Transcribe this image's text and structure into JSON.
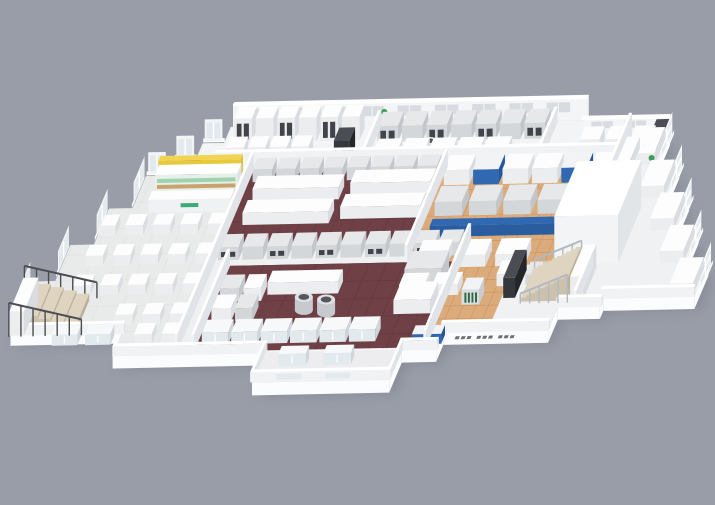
{
  "meta": {
    "description": "Isometric 3D cutaway architectural rendering of a facility floor plan with dining hall, kiosk shop, commercial kitchens on maroon floors, a wood-floored production area with machinery, lab wing, staircases and perimeter bay windows"
  },
  "scene": {
    "canvas": {
      "w": 715,
      "h": 505,
      "bg": "#989da8"
    },
    "proj": {
      "ox": 233,
      "oy": 127,
      "ux": 0.98,
      "uy": -0.02,
      "vx": -0.42,
      "vy": 1
    },
    "palette": {
      "slabSide": "#fbfcfe",
      "floorBase": "#f3f4f6",
      "dining": "#e9ebeb",
      "diningGrid": "#e0e3e3",
      "maroon": "#6f4147",
      "maroonGrid": "#643940",
      "wood": "#dcab7c",
      "woodGrid": "#cc9763",
      "corridor": "#eef0f1",
      "wing": "#eff1f3",
      "porch": "#ededef",
      "wallFace": "#f4f5f7",
      "wallWindow": "#d8dce1",
      "glass": "#e3eaee",
      "blue": "#3069b1",
      "yellow": "#f0d452",
      "greenLogo": "#3cab77",
      "shelfGreen": "#9fd3ae",
      "shelfWood": "#c9a36d",
      "steps": "#ded4c0",
      "railDark": "#4b4d52",
      "railLight": "#b3b9c0",
      "plant": "#3f9d5a",
      "shadow": "#787d88"
    },
    "outline": [
      [
        0,
        0
      ],
      [
        362,
        0
      ],
      [
        362,
        15
      ],
      [
        452,
        15
      ],
      [
        452,
        48
      ],
      [
        476,
        48
      ],
      [
        476,
        81
      ],
      [
        500,
        81
      ],
      [
        500,
        114
      ],
      [
        524,
        114
      ],
      [
        524,
        147
      ],
      [
        548,
        147
      ],
      [
        548,
        180
      ],
      [
        455,
        180
      ],
      [
        455,
        188
      ],
      [
        412,
        188
      ],
      [
        412,
        211
      ],
      [
        305,
        211
      ],
      [
        305,
        228
      ],
      [
        270,
        228
      ],
      [
        270,
        258
      ],
      [
        130,
        258
      ],
      [
        130,
        228
      ],
      [
        -25,
        228
      ],
      [
        -25,
        203
      ],
      [
        -140,
        203
      ],
      [
        -140,
        152
      ],
      [
        -116,
        152
      ],
      [
        -116,
        116
      ],
      [
        -92,
        116
      ],
      [
        -92,
        80
      ],
      [
        -68,
        80
      ],
      [
        -68,
        48
      ],
      [
        -46,
        48
      ],
      [
        -46,
        32
      ],
      [
        -24,
        32
      ],
      [
        -24,
        16
      ],
      [
        -2,
        16
      ],
      [
        -2,
        0
      ]
    ],
    "slabDepth": 13,
    "zones": [
      {
        "name": "dining-floor",
        "fill": "dining",
        "grid": {
          "step": 26,
          "c": "diningGrid"
        },
        "pts": [
          [
            -68,
            48
          ],
          [
            38,
            48
          ],
          [
            38,
            226
          ],
          [
            -25,
            226
          ],
          [
            -25,
            203
          ],
          [
            -140,
            203
          ],
          [
            -140,
            152
          ],
          [
            -116,
            152
          ],
          [
            -116,
            116
          ],
          [
            -92,
            116
          ],
          [
            -92,
            80
          ],
          [
            -68,
            80
          ]
        ]
      },
      {
        "name": "back-kitchen-strip",
        "fill": "floorBase",
        "pts": [
          [
            0,
            2
          ],
          [
            412,
            2
          ],
          [
            412,
            42
          ],
          [
            0,
            42
          ]
        ]
      },
      {
        "name": "upper-kitchen-maroon",
        "fill": "maroon",
        "grid": {
          "step": 18,
          "c": "maroonGrid"
        },
        "pts": [
          [
            38,
            42
          ],
          [
            236,
            42
          ],
          [
            236,
            118
          ],
          [
            38,
            118
          ]
        ]
      },
      {
        "name": "kitchen-corridor",
        "fill": "corridor",
        "pts": [
          [
            38,
            118
          ],
          [
            292,
            118
          ],
          [
            292,
            140
          ],
          [
            38,
            140
          ]
        ]
      },
      {
        "name": "corridor-side",
        "fill": "corridor",
        "pts": [
          [
            38,
            140
          ],
          [
            55,
            140
          ],
          [
            55,
            226
          ],
          [
            38,
            226
          ]
        ]
      },
      {
        "name": "lower-kitchen-maroon",
        "fill": "maroon",
        "grid": {
          "step": 18,
          "c": "maroonGrid"
        },
        "pts": [
          [
            55,
            140
          ],
          [
            292,
            140
          ],
          [
            292,
            226
          ],
          [
            55,
            226
          ]
        ]
      },
      {
        "name": "production-wood-floor",
        "fill": "wood",
        "grid": {
          "step": 13,
          "c": "woodGrid"
        },
        "pts": [
          [
            236,
            42
          ],
          [
            412,
            42
          ],
          [
            412,
            211
          ],
          [
            305,
            211
          ],
          [
            305,
            226
          ],
          [
            292,
            226
          ],
          [
            292,
            140
          ],
          [
            236,
            140
          ]
        ]
      },
      {
        "name": "right-lab-wing",
        "fill": "wing",
        "pts": [
          [
            412,
            15
          ],
          [
            452,
            15
          ],
          [
            452,
            48
          ],
          [
            476,
            48
          ],
          [
            476,
            81
          ],
          [
            500,
            81
          ],
          [
            500,
            114
          ],
          [
            524,
            114
          ],
          [
            524,
            147
          ],
          [
            548,
            147
          ],
          [
            548,
            180
          ],
          [
            455,
            180
          ],
          [
            455,
            188
          ],
          [
            412,
            188
          ]
        ]
      },
      {
        "name": "stair-lobby",
        "fill": "wing",
        "pts": [
          [
            350,
            145
          ],
          [
            455,
            145
          ],
          [
            455,
            188
          ],
          [
            412,
            188
          ],
          [
            412,
            211
          ],
          [
            350,
            211
          ]
        ]
      },
      {
        "name": "porch",
        "fill": "porch",
        "pts": [
          [
            130,
            228
          ],
          [
            270,
            228
          ],
          [
            270,
            256
          ],
          [
            130,
            256
          ]
        ]
      }
    ],
    "backWalls": [
      {
        "x1": 0,
        "y": 0,
        "x2": 362,
        "h": 22,
        "win": {
          "start": 16,
          "step": 38,
          "w": 24,
          "n": 9,
          "z1": 8,
          "z2": 18
        }
      },
      {
        "x1": 362,
        "y": 15,
        "x2": 452,
        "h": 16,
        "win": {
          "start": 372,
          "step": 34,
          "w": 22,
          "n": 2,
          "z1": 6,
          "z2": 13
        }
      }
    ],
    "walls": [
      [
        0,
        -3,
        362,
        3,
        22
      ],
      [
        362,
        12,
        90,
        3,
        16
      ],
      [
        37,
        44,
        3,
        182,
        18
      ],
      [
        0,
        41,
        414,
        3,
        18
      ],
      [
        149,
        2,
        3,
        39,
        16
      ],
      [
        329,
        2,
        3,
        39,
        16
      ],
      [
        235,
        44,
        3,
        96,
        17
      ],
      [
        291,
        119,
        3,
        107,
        17
      ],
      [
        411,
        16,
        3,
        72,
        22
      ],
      [
        428,
        148,
        3,
        40,
        16
      ],
      [
        54,
        140,
        3,
        86,
        17
      ],
      [
        -25,
        226,
        157,
        3,
        10
      ],
      [
        268,
        226,
        39,
        3,
        10
      ],
      [
        303,
        209,
        110,
        3,
        10
      ],
      [
        411,
        186,
        46,
        3,
        10
      ],
      [
        453,
        178,
        95,
        3,
        10
      ],
      [
        128,
        228,
        3,
        29,
        10
      ],
      [
        268,
        228,
        3,
        29,
        10
      ],
      [
        128,
        255,
        143,
        3,
        10
      ],
      [
        -140,
        203,
        117,
        3,
        10
      ]
    ],
    "rows": [
      {
        "x": 8,
        "y": 4,
        "dx": 22,
        "n": 6,
        "w": 18,
        "d": 12,
        "h": 24,
        "c": "w",
        "slot": 1
      },
      {
        "x": 8,
        "y": 24,
        "dx": 22,
        "n": 4,
        "w": 18,
        "d": 11,
        "h": 14,
        "c": "w"
      },
      {
        "x": 155,
        "y": 4,
        "dx": 25,
        "n": 7,
        "w": 21,
        "d": 14,
        "h": 16,
        "c": "s",
        "slot": 1
      },
      {
        "x": 160,
        "y": 26,
        "dx": 28,
        "n": 5,
        "w": 24,
        "d": 11,
        "h": 11,
        "c": "w"
      },
      {
        "x": 368,
        "y": 20,
        "dx": 26,
        "n": 3,
        "w": 20,
        "d": 13,
        "h": 13,
        "c": "w"
      },
      {
        "x": 44,
        "y": 45,
        "dx": 24,
        "n": 8,
        "w": 20,
        "d": 11,
        "h": 13,
        "c": "s"
      },
      {
        "x": 42,
        "y": 121,
        "dx": 25,
        "n": 10,
        "w": 21,
        "d": 13,
        "h": 13,
        "c": "s",
        "slot": 1
      },
      {
        "x": 62,
        "y": 206,
        "dx": 30,
        "n": 6,
        "w": 27,
        "d": 13,
        "h": 12,
        "c": "g"
      },
      {
        "x": 242,
        "y": 48,
        "dx": 30,
        "n": 6,
        "w": 26,
        "d": 15,
        "h": 15,
        "c": "w"
      },
      {
        "x": 246,
        "y": 78,
        "dx": 35,
        "n": 5,
        "w": 28,
        "d": 16,
        "h": 14,
        "c": "s"
      },
      {
        "x": 250,
        "y": 130,
        "dx": 40,
        "n": 3,
        "w": 30,
        "d": 16,
        "h": 12,
        "c": "w"
      }
    ],
    "boxes": [
      [
        118,
        22,
        16,
        13,
        19,
        "d"
      ],
      [
        440,
        18,
        14,
        13,
        17,
        "d"
      ],
      [
        52,
        62,
        88,
        13,
        12,
        "w"
      ],
      [
        52,
        86,
        88,
        13,
        12,
        "w"
      ],
      [
        150,
        58,
        82,
        13,
        12,
        "w"
      ],
      [
        150,
        82,
        82,
        13,
        12,
        "w"
      ],
      [
        108,
        158,
        72,
        12,
        12,
        "w"
      ],
      [
        62,
        162,
        20,
        14,
        13,
        "s"
      ],
      [
        86,
        162,
        18,
        14,
        13,
        "w"
      ],
      [
        62,
        182,
        20,
        14,
        13,
        "w"
      ],
      [
        86,
        182,
        18,
        14,
        13,
        "s"
      ],
      [
        246,
        148,
        38,
        18,
        19,
        "s"
      ],
      [
        246,
        174,
        38,
        18,
        14,
        "w"
      ],
      [
        272,
        48,
        26,
        15,
        15,
        "b"
      ],
      [
        362,
        48,
        26,
        15,
        15,
        "b"
      ],
      [
        250,
        108,
        132,
        7,
        11,
        "B"
      ],
      [
        386,
        104,
        20,
        14,
        13,
        "w"
      ],
      [
        244,
        162,
        26,
        12,
        11,
        "w"
      ],
      [
        278,
        162,
        26,
        12,
        11,
        "w"
      ],
      [
        312,
        172,
        18,
        12,
        15,
        "G"
      ],
      [
        340,
        152,
        22,
        14,
        12,
        "w"
      ],
      [
        369,
        152,
        16,
        13,
        10,
        "s"
      ],
      [
        278,
        214,
        30,
        9,
        10,
        "b"
      ],
      [
        390,
        90,
        65,
        55,
        48,
        "W"
      ],
      [
        352,
        150,
        12,
        28,
        20,
        "d"
      ],
      [
        422,
        150,
        13,
        32,
        24,
        "w"
      ],
      [
        415,
        30,
        13,
        110,
        12,
        "w"
      ],
      [
        426,
        21,
        24,
        26,
        12,
        "w"
      ],
      [
        450,
        54,
        24,
        26,
        12,
        "w"
      ],
      [
        474,
        87,
        24,
        26,
        12,
        "w"
      ],
      [
        498,
        120,
        24,
        26,
        12,
        "w"
      ],
      [
        522,
        153,
        24,
        26,
        12,
        "w"
      ],
      [
        150,
        234,
        28,
        8,
        12,
        "g"
      ],
      [
        196,
        234,
        28,
        8,
        12,
        "g"
      ],
      [
        -92,
        208,
        26,
        9,
        11,
        "g"
      ],
      [
        -58,
        208,
        26,
        9,
        11,
        "g"
      ],
      [
        -34,
        46,
        22,
        12,
        14,
        "d"
      ],
      [
        -140,
        172,
        15,
        34,
        24,
        "w"
      ]
    ],
    "stairs": [
      {
        "name": "staircase-left",
        "x": -73,
        "y": 172,
        "n": 5,
        "sw": -13,
        "d": 32,
        "h0": 7,
        "dh": 3.5
      },
      {
        "name": "staircase-right",
        "x": 372,
        "y": 152,
        "n": 10,
        "sw": 4.8,
        "d": 30,
        "h0": 4,
        "dh": 2.2
      }
    ],
    "railings": [
      {
        "x1": -66,
        "y1": 207,
        "x2": -140,
        "y2": 207,
        "n": 7,
        "h1": 16,
        "h2": 34,
        "c": "railDark"
      },
      {
        "x1": -66,
        "y1": 170,
        "x2": -140,
        "y2": 170,
        "n": 7,
        "h1": 16,
        "h2": 34,
        "c": "railDark"
      },
      {
        "x1": 372,
        "y1": 150,
        "x2": 420,
        "y2": 150,
        "n": 6,
        "h1": 10,
        "h2": 28,
        "c": "railLight"
      },
      {
        "x1": 372,
        "y1": 184,
        "x2": 420,
        "y2": 184,
        "n": 6,
        "h1": 10,
        "h2": 28,
        "c": "railLight"
      }
    ],
    "bays": {
      "E": [
        [
          452,
          18,
          27
        ],
        [
          476,
          51,
          27
        ],
        [
          500,
          84,
          27
        ],
        [
          524,
          117,
          27
        ],
        [
          548,
          150,
          27
        ]
      ],
      "W": [
        [
          -140,
          156,
          26
        ],
        [
          -116,
          120,
          26
        ],
        [
          -92,
          84,
          26
        ],
        [
          -68,
          52,
          26
        ]
      ],
      "N": [
        [
          -66,
          48,
          18
        ],
        [
          -44,
          32,
          18
        ],
        [
          -22,
          16,
          18
        ]
      ]
    },
    "tables": {
      "x0": -92,
      "y0": 96,
      "dx": 28,
      "dy": 30,
      "cols": 5,
      "rows": 4,
      "w": 18,
      "d": 11,
      "h": 10,
      "skip": [
        [
          0,
          3
        ],
        [
          1,
          3
        ]
      ],
      "extras": [
        [
          -8,
          206
        ],
        [
          20,
          206
        ]
      ]
    },
    "kiosk": {
      "x": -50,
      "y": 56,
      "w": 84
    },
    "cylinders": [
      [
        152,
        186,
        9,
        13
      ],
      [
        176,
        189,
        9,
        13
      ],
      [
        195,
        29,
        7,
        11
      ],
      [
        213,
        29,
        7,
        11
      ]
    ],
    "plants": [
      [
        157,
        6
      ],
      [
        452,
        58
      ]
    ],
    "vents": [
      [
        320,
        216
      ],
      [
        342,
        216
      ],
      [
        364,
        216
      ]
    ],
    "wallGlass": [
      [
        155,
        258,
        180,
        258
      ],
      [
        205,
        258,
        230,
        258
      ]
    ]
  }
}
